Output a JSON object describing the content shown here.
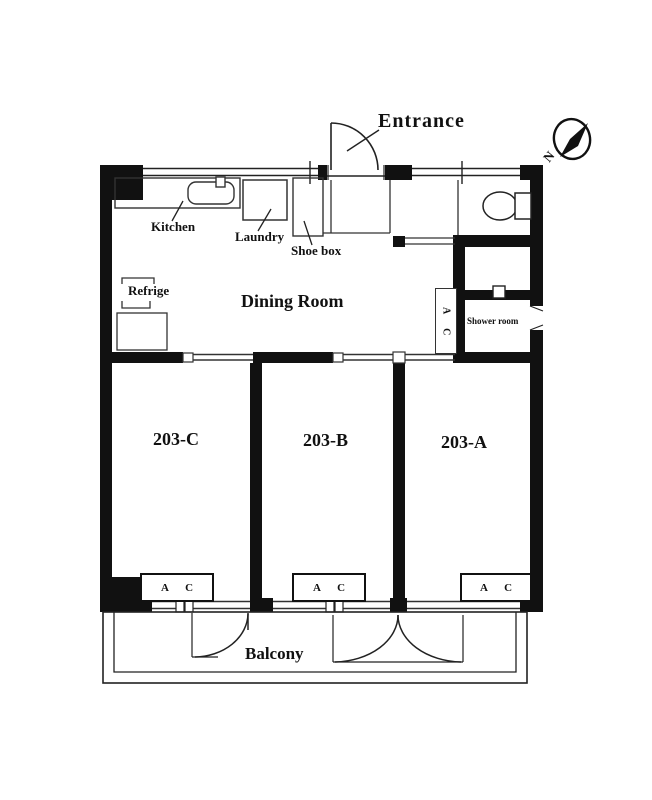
{
  "title": "Apartment 203 floor plan",
  "colors": {
    "line": "#1a1a1a",
    "background": "#ffffff"
  },
  "labels": {
    "entrance": "Entrance",
    "kitchen": "Kitchen",
    "laundry": "Laundry",
    "shoe_box": "Shoe box",
    "refrige": "Refrige",
    "dining_room": "Dining Room",
    "shower_room": "Shower room",
    "balcony": "Balcony",
    "ac_unit": "A C",
    "north": "N"
  },
  "rooms": {
    "c": "203-C",
    "b": "203-B",
    "a": "203-A"
  },
  "icons": [
    "compass-icon",
    "entrance-door-arc",
    "sink-icon",
    "toilet-icon",
    "balcony-door-arcs",
    "window-symbols"
  ]
}
